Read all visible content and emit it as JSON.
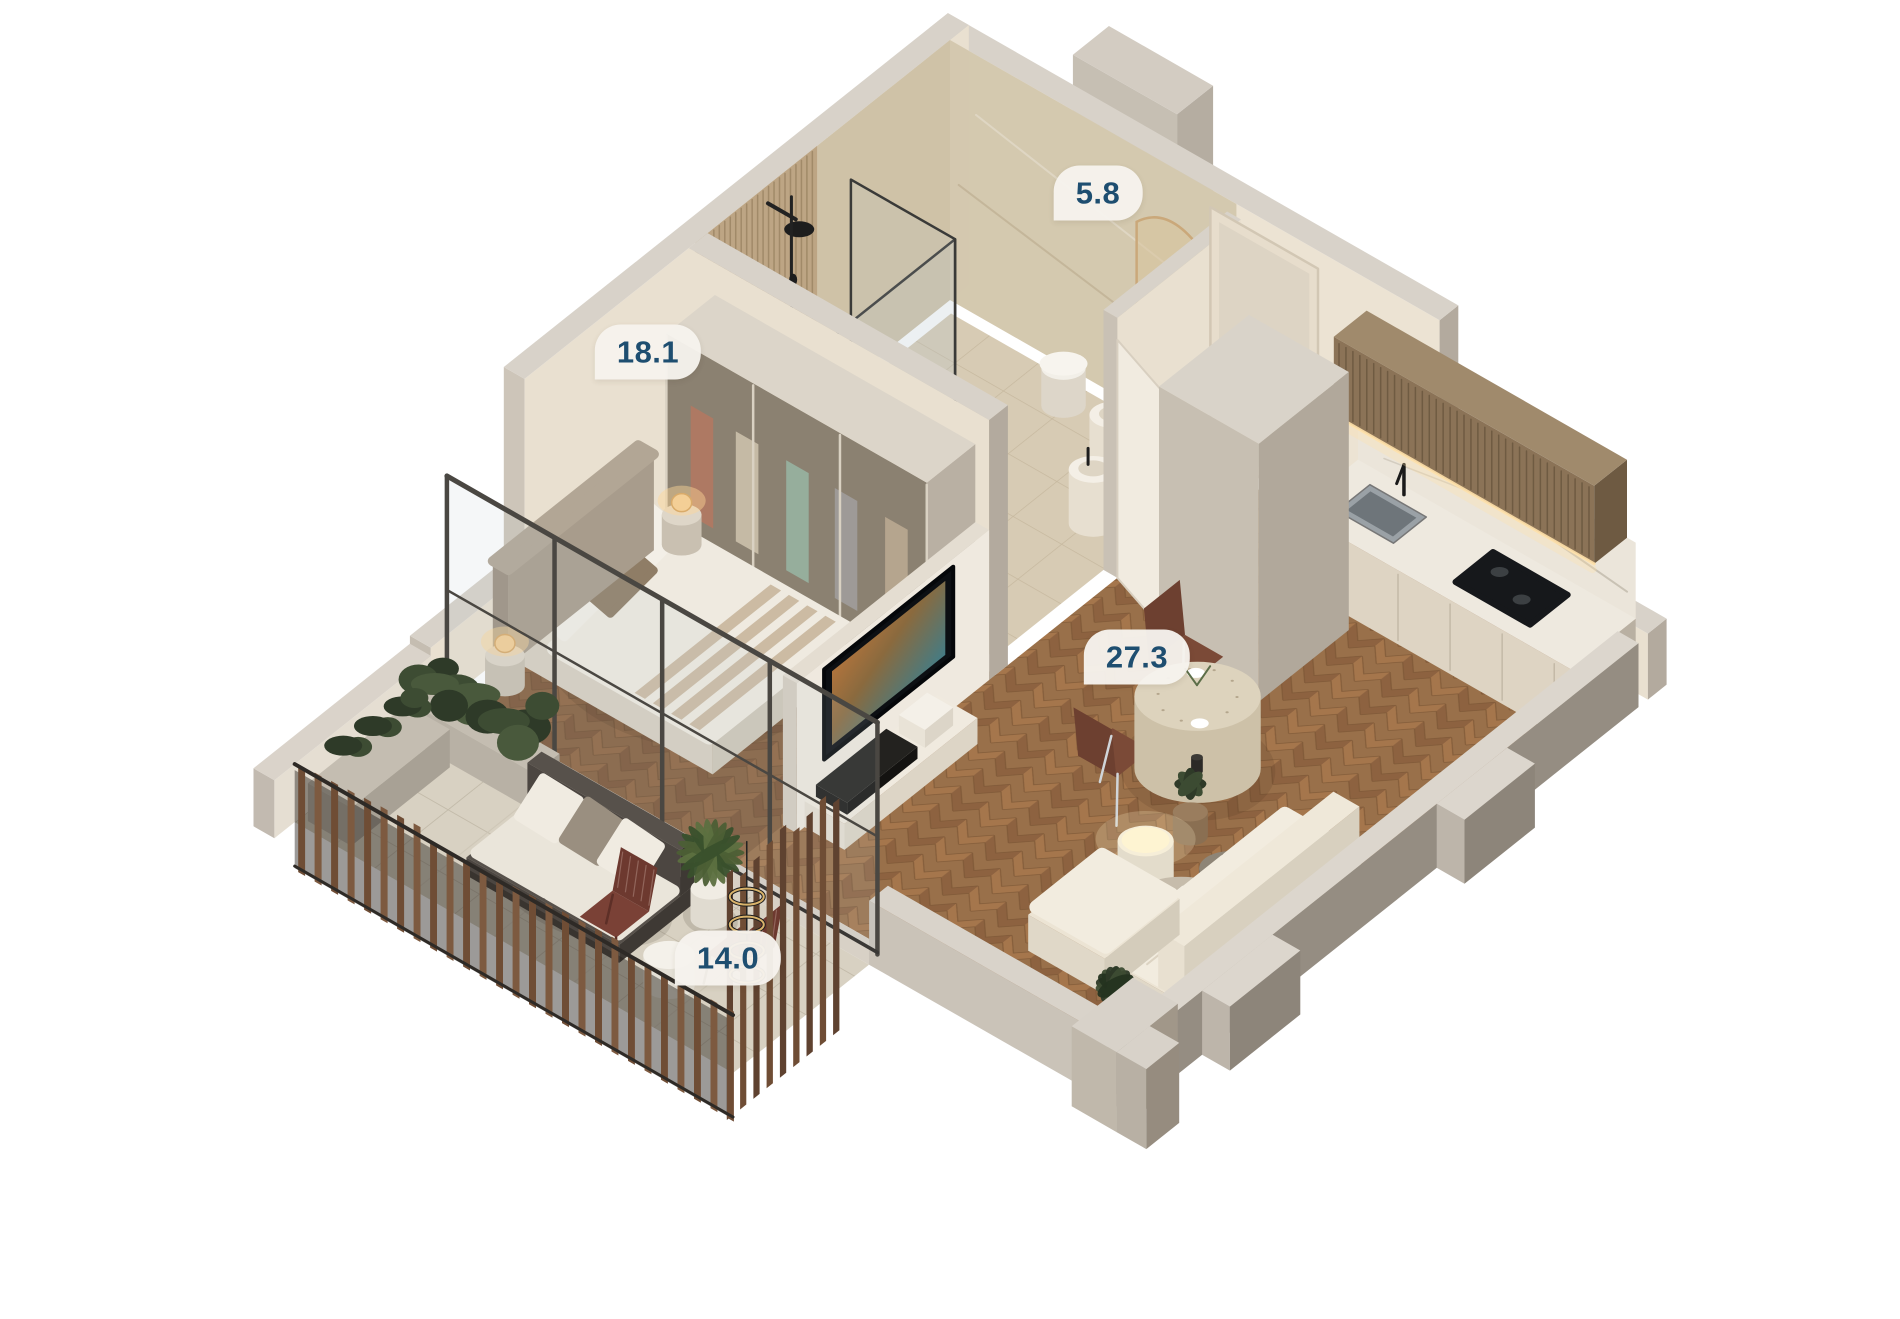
{
  "page": {
    "type": "3d-isometric-floorplan-render",
    "background": "#ffffff"
  },
  "rooms": [
    {
      "id": "bathroom",
      "area_label": "5.8"
    },
    {
      "id": "bedroom",
      "area_label": "18.1"
    },
    {
      "id": "living-kitchen",
      "area_label": "27.3"
    },
    {
      "id": "terrace",
      "area_label": "14.0"
    }
  ],
  "palette": {
    "label_bg": "rgba(246,243,237,0.96)",
    "label_text": "#1e4e70",
    "wall_top": "#d8d2c9",
    "wall_inner": "#ece3d3",
    "wall_inner2": "#e9e0d0",
    "wall_outer_se": "#958d82",
    "wall_outer_sw": "#c9c2b7",
    "wall_end": "#b3aa9e",
    "wood_a": "#a5764c",
    "wood_b": "#8d6240",
    "wood_bg": "#99704a",
    "wood_line": "#7a5434",
    "stone": "#d8d1c2",
    "stone_line": "#c3bbaa",
    "bath_floor": "#d7cbb4",
    "travertine": "#cbbda1",
    "fluted": "#bda584",
    "flute_line": "rgba(120,98,66,0.4)",
    "cabinet_wood": "#8b7357",
    "cabinet_top": "#a08a6c",
    "counter": "#eee9df",
    "fronts": "#ded4c3",
    "marble": "#ebe5da",
    "linen": "#efeae0",
    "blanket": "#c9b69d",
    "headboard": "#b2a695",
    "sofa": "#ece4d4",
    "sofa_hi": "#f2ecdf",
    "glass": "rgba(185,200,205,0.14)",
    "frame": "#4a4742",
    "rail_a": "#6f4d35",
    "rail_b": "#7d5a40",
    "mesh": "rgba(35,30,26,0.45)",
    "plant_dark": "#2e3a28",
    "plant_mid": "#3d4c33",
    "plant_light": "#49593c",
    "maroon": "#6d392f",
    "chrome": "#d0d5d9",
    "glow": "rgba(255,215,150,0.45)",
    "lamp": "#f4cf96",
    "tv_dark": "#0c0f13",
    "column": "#c7bfb2"
  }
}
